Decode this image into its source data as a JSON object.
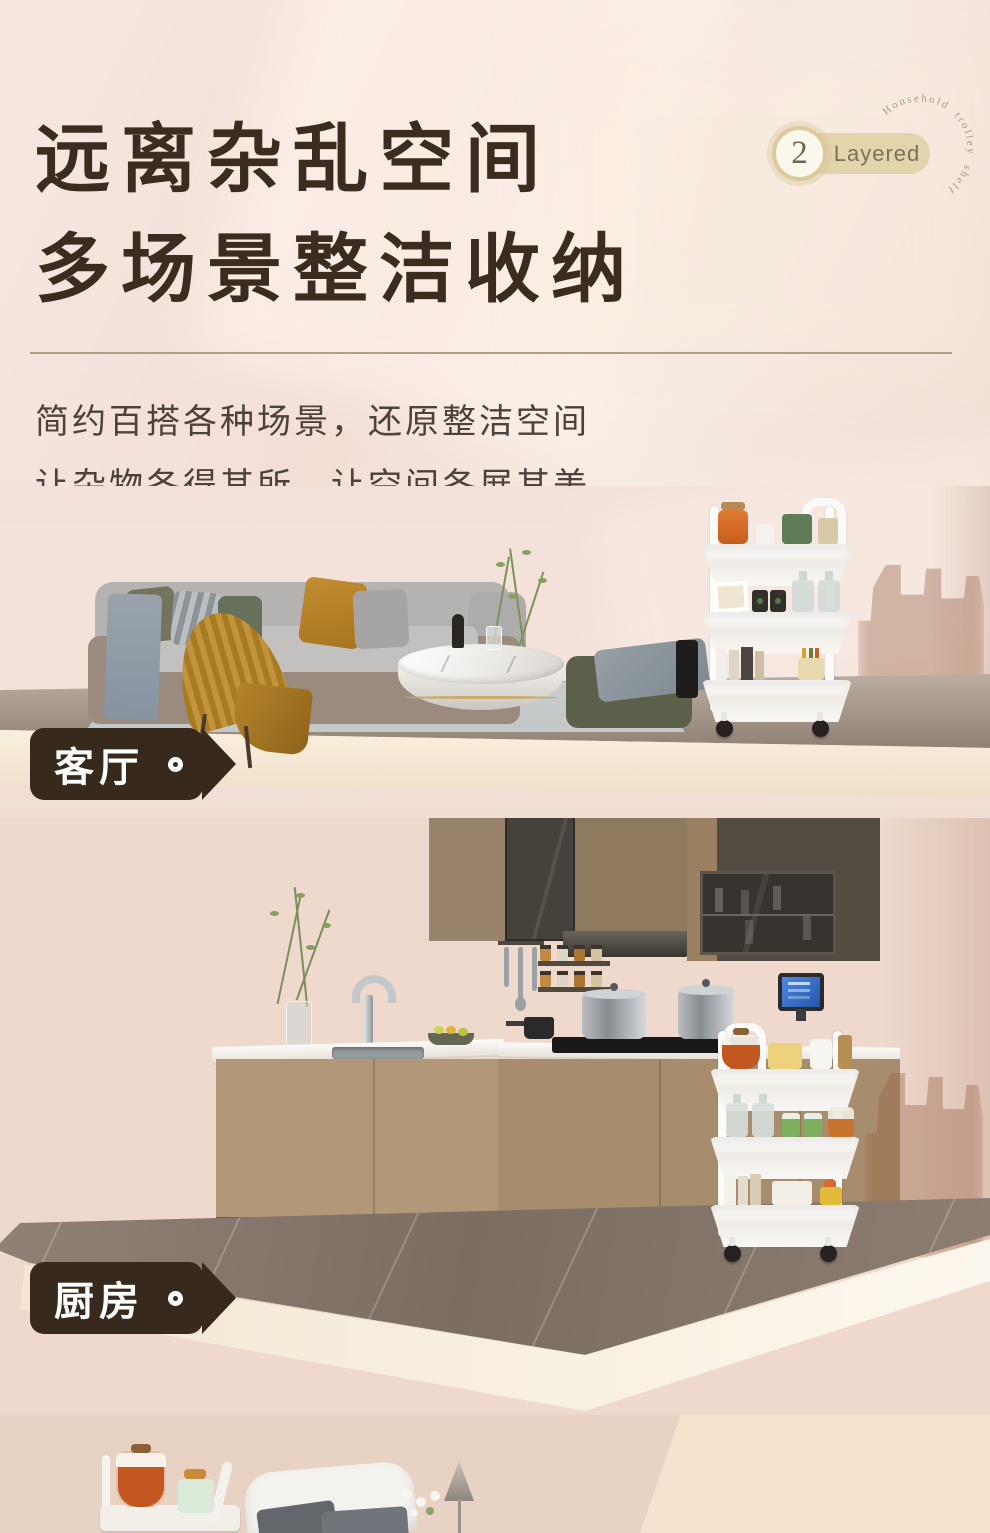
{
  "header": {
    "title_line1": "远离杂乱空间",
    "title_line2": "多场景整洁收纳",
    "badge": {
      "number": "2",
      "label": "Layered",
      "arc_text": "Household trolley shelf"
    },
    "subtitle_line1": "简约百搭各种场景，还原整洁空间",
    "subtitle_line2": "让杂物各得其所，让空间各展其美"
  },
  "scenes": {
    "living_room": {
      "label": "客厅"
    },
    "kitchen": {
      "label": "厨房"
    }
  },
  "icons": {
    "tag_ring": "circle-ring",
    "badge_number_seal": "numbered-circle"
  },
  "colors": {
    "background_pink": "#f3e1d8",
    "title_brown": "#3a2c1f",
    "subtitle_gray": "#4b433b",
    "divider_tan": "#b19f85",
    "tag_background": "#38291d",
    "tag_text": "#ffffff",
    "badge_pill": "#e4d4ab",
    "badge_ring": "#dcc99e",
    "badge_text": "#7d7158",
    "arc_text_gray": "#a1978a",
    "trolley_white": "#fbfaf8",
    "slab_cream": "#f3e7d2",
    "floor_marble": "#8d7e72"
  }
}
